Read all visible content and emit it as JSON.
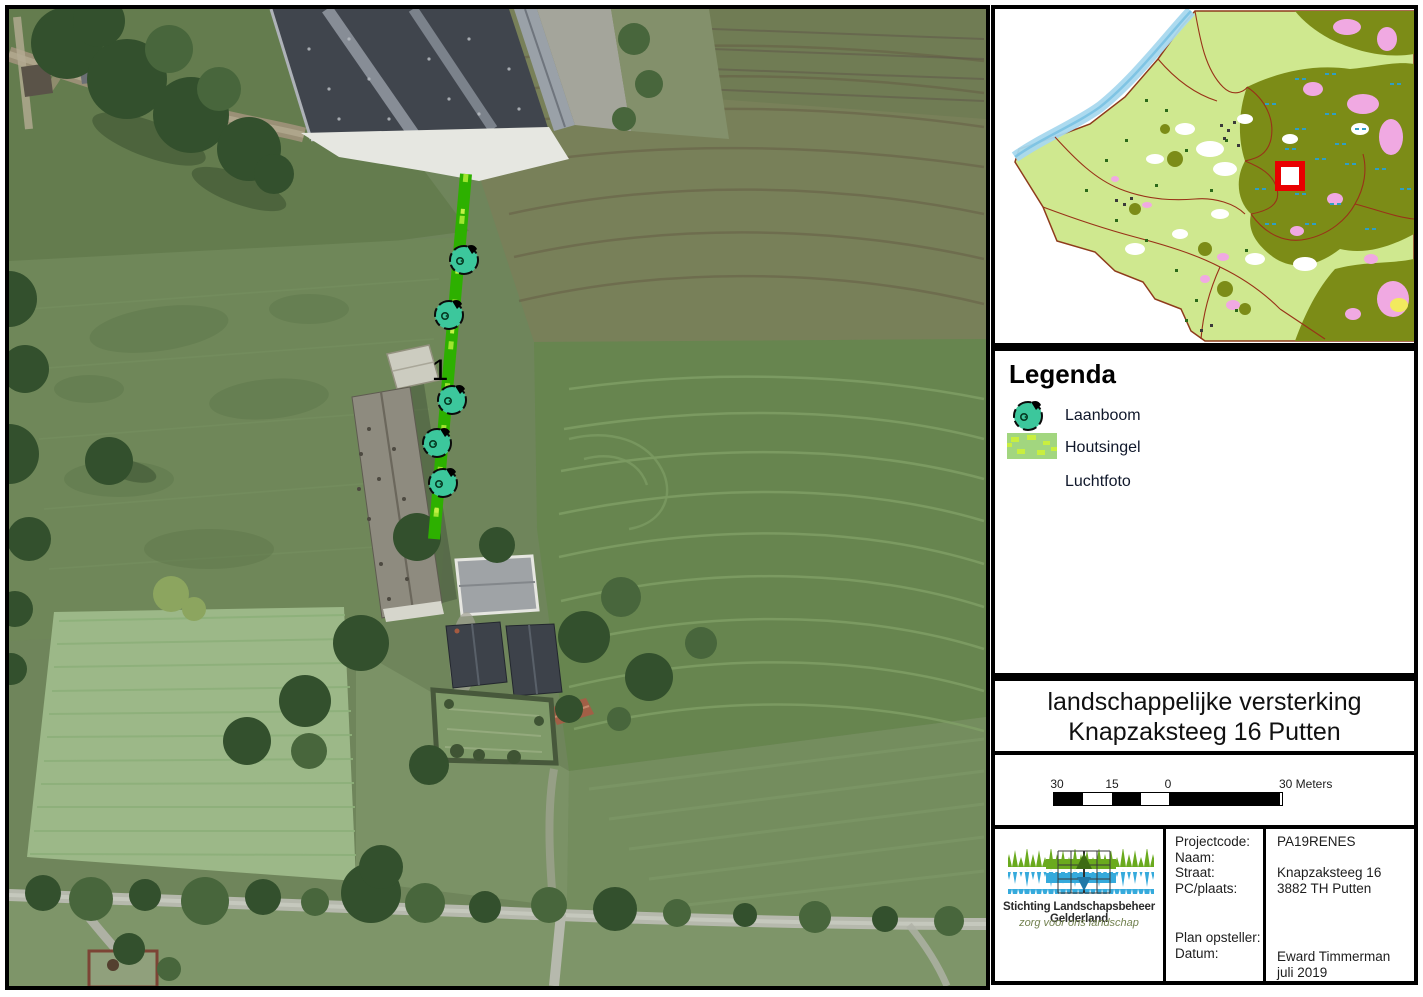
{
  "document": {
    "kind": "landscape-plan-sheet"
  },
  "aerial": {
    "plan_label": "1"
  },
  "legend": {
    "title": "Legenda",
    "items": [
      {
        "id": "laanboom",
        "label": "Laanboom"
      },
      {
        "id": "houtsingel",
        "label": "Houtsingel"
      },
      {
        "id": "luchtfoto",
        "label": "Luchtfoto"
      }
    ]
  },
  "title_block": {
    "line1": "landschappelijke versterking",
    "line2": "Knapzaksteeg 16 Putten"
  },
  "scale_bar": {
    "tick1": "30",
    "tick2": "15",
    "tick3": "0",
    "tick4": "30 Meters"
  },
  "logo": {
    "org": "Stichting Landschapsbeheer Gelderland",
    "tagline": "zorg voor ons landschap"
  },
  "info": {
    "labels": {
      "projectcode": "Projectcode:",
      "naam": "Naam:",
      "straat": "Straat:",
      "pcplaats": "PC/plaats:",
      "plan_opsteller": "Plan opsteller:",
      "datum": "Datum:"
    },
    "values": {
      "projectcode": "PA19RENES",
      "naam": "",
      "straat": "Knapzaksteeg 16",
      "pcplaats": "3882 TH Putten",
      "opsteller": "Eward Timmerman",
      "datum": "juli 2019"
    }
  },
  "colors": {
    "plan_line": "#2db000",
    "plan_line_dash": "#9fe52f",
    "tree_fill": "#3cc79c",
    "houtsingel_fill": "#a2d67f",
    "houtsingel_dash": "#c9ef3f",
    "marker_red": "#e90000"
  }
}
